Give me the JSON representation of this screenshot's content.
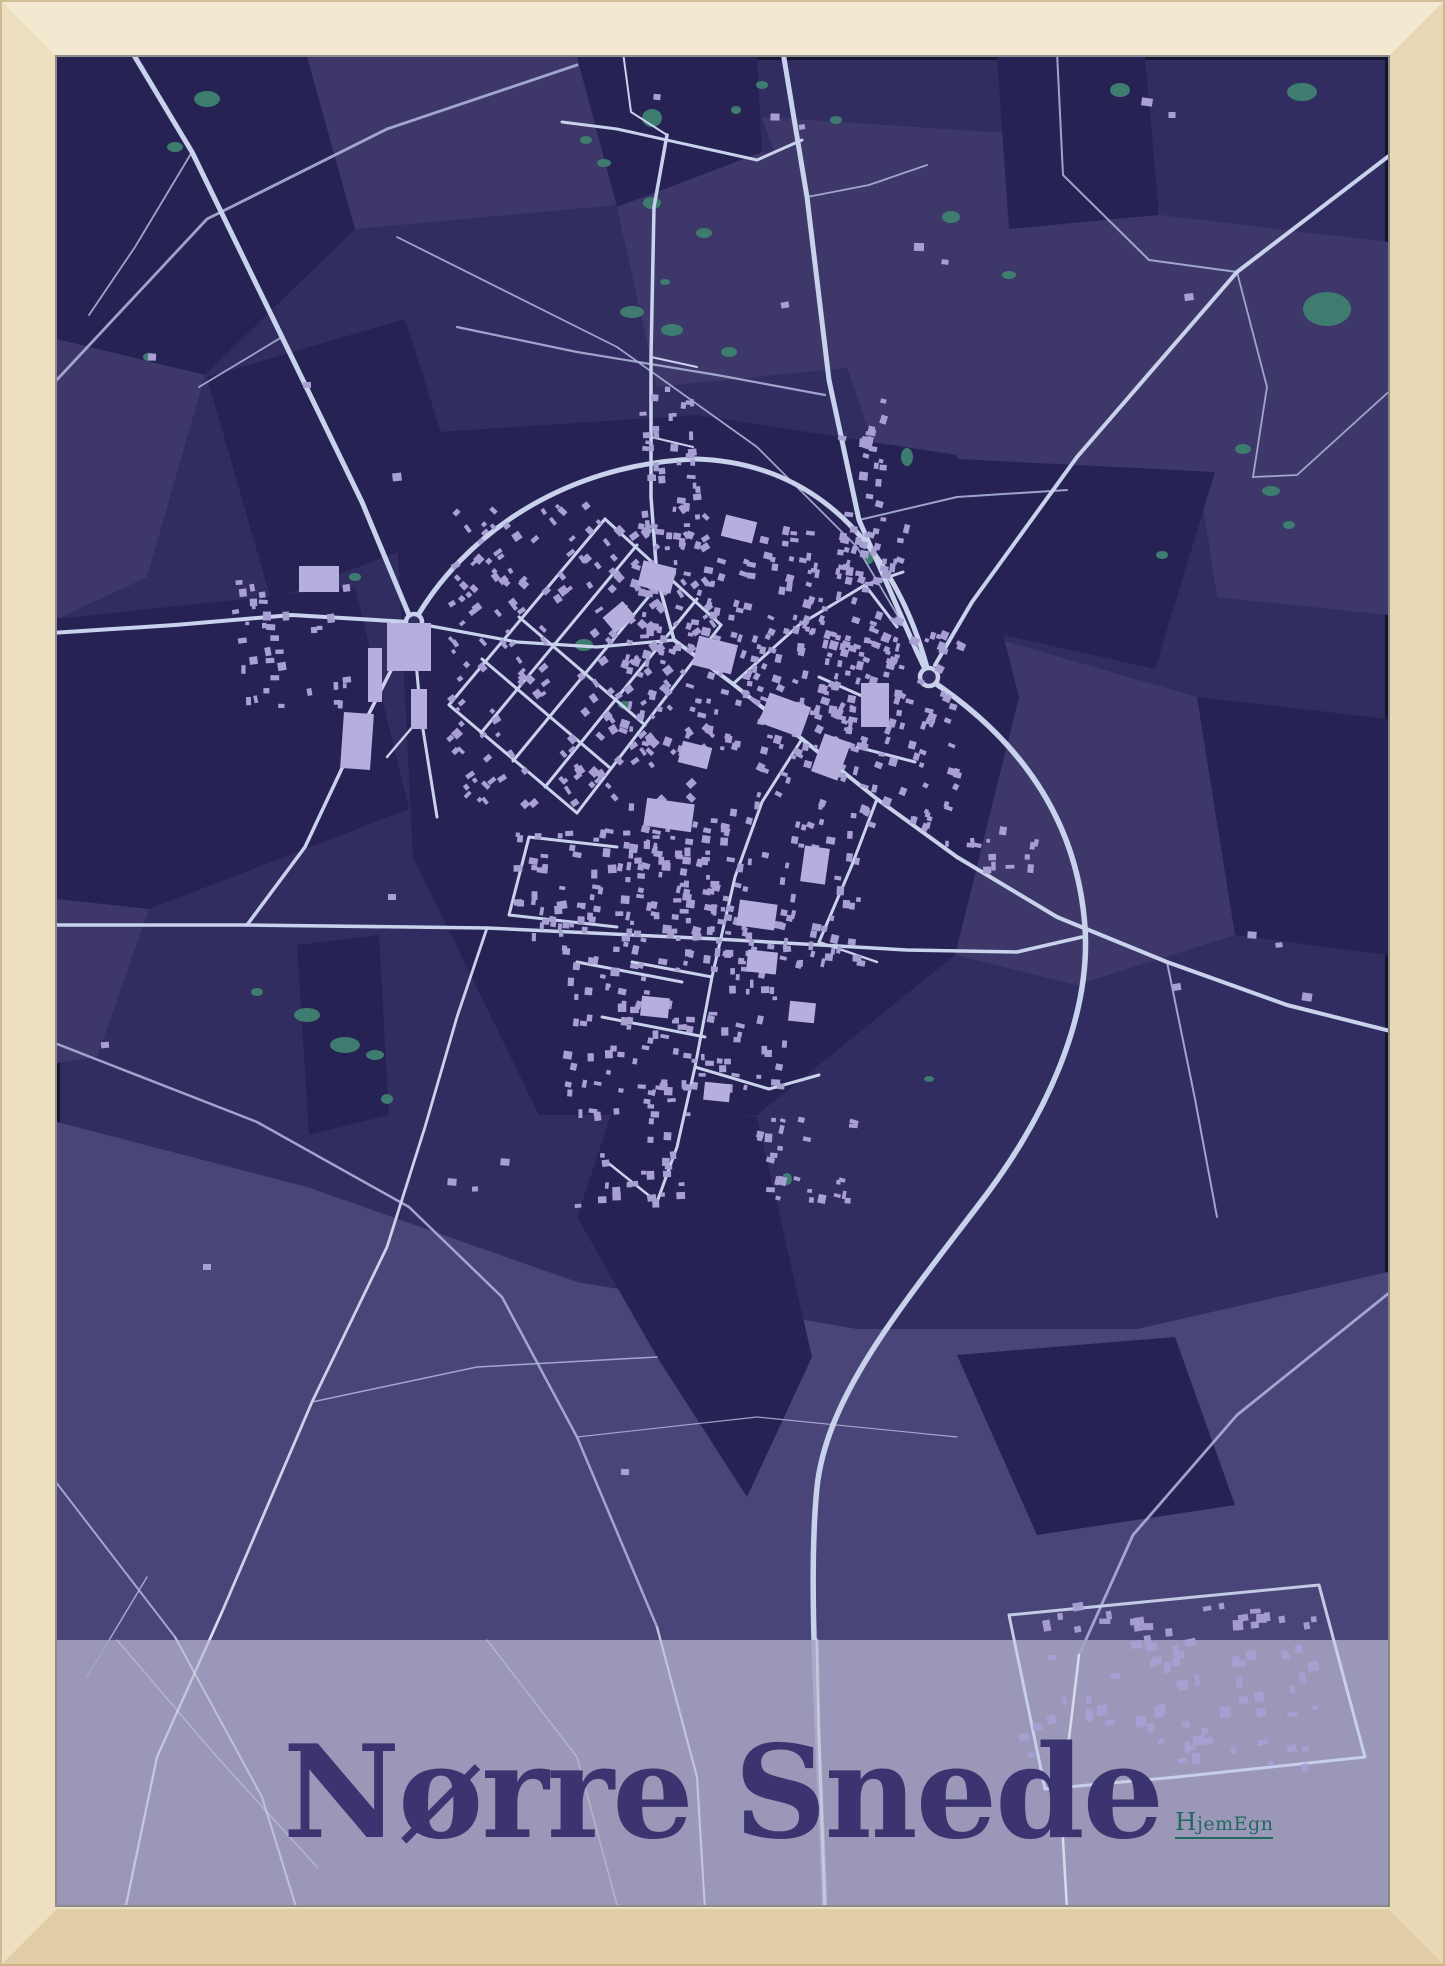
{
  "poster": {
    "title": "Nørre Snede",
    "brand": "HjemEgn"
  },
  "palette": {
    "frame_wood": "#eee0c2",
    "map_background": "#322d61",
    "field_dark": "#262253",
    "field_light": "#3d3869",
    "field_lighter": "#4a4578",
    "lake_green": "#3d7c6e",
    "road_major": "#c9d2ec",
    "road_minor": "#aab1d6",
    "building": "#a89fd3",
    "building_large": "#b6aedd",
    "band": "#a6a3c2",
    "title_text": "#3b3470",
    "brand_text": "#23695e"
  }
}
